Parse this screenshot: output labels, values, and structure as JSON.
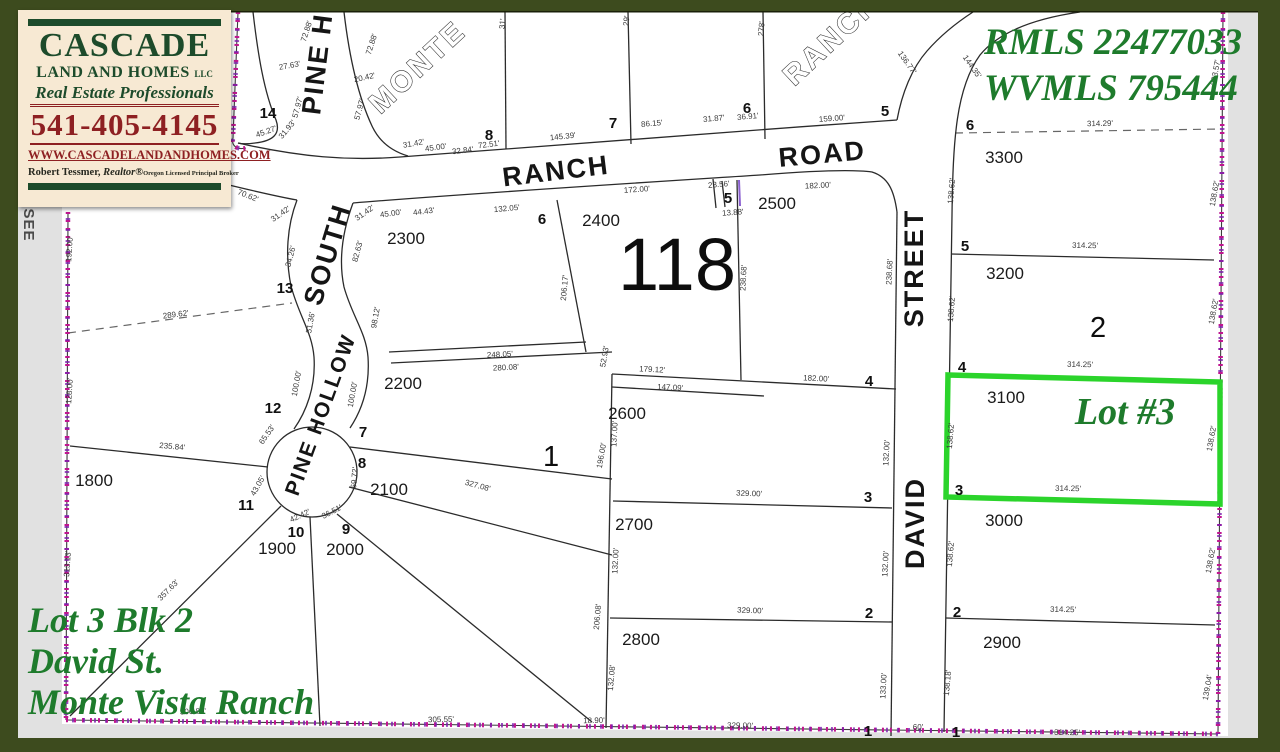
{
  "branding": {
    "company_line1": "CASCADE",
    "company_line2": "LAND AND HOMES",
    "company_suffix": "LLC",
    "tagline": "Real Estate Professionals",
    "phone": "541-405-4145",
    "website": "WWW.CASCADELANDANDHOMES.COM",
    "agent_name": "Robert Tessmer,",
    "agent_designation": "Realtor®",
    "agent_license": "Oregon Licensed Principal Broker"
  },
  "listing": {
    "mls_line1": "RMLS 22477033",
    "mls_line2": "WVMLS 795444",
    "highlight_label": "Lot #3",
    "caption_line1": "Lot 3 Blk 2",
    "caption_line2": "David St.",
    "caption_line3": "Monte Vista Ranch"
  },
  "colors": {
    "frame_green": "#3d4b1e",
    "page_gray": "#e1e1e1",
    "logo_cream": "#f7e9d3",
    "logo_green": "#1d4b2b",
    "logo_maroon": "#8e2022",
    "annotation_green": "#1e7b2c",
    "highlight_green": "#2bd42b",
    "boundary_magenta": "#c01590",
    "line_dark": "#2b2b2b"
  },
  "map": {
    "section_number": "118",
    "edge_note": "SEE",
    "labels": [
      {
        "t": "PINE HOLLOW",
        "x": 333,
        "y": 10,
        "r": -83,
        "c": "street"
      },
      {
        "t": "MONTE",
        "x": 424,
        "y": 74,
        "r": -43,
        "c": "outline"
      },
      {
        "t": "RANCH",
        "x": 838,
        "y": 46,
        "r": -43,
        "c": "outline"
      },
      {
        "t": "RANCH",
        "x": 557,
        "y": 180,
        "r": -7,
        "c": "street"
      },
      {
        "t": "ROAD",
        "x": 823,
        "y": 163,
        "r": -5,
        "c": "street"
      },
      {
        "t": "SOUTH",
        "x": 336,
        "y": 257,
        "r": -73,
        "c": "street"
      },
      {
        "t": "PINE HOLLOW",
        "x": 327,
        "y": 417,
        "r": -70,
        "c": "streetsm"
      },
      {
        "t": "DAVID",
        "x": 924,
        "y": 523,
        "r": -90,
        "c": "street"
      },
      {
        "t": "STREET",
        "x": 923,
        "y": 268,
        "r": -90,
        "c": "street"
      },
      {
        "t": "118",
        "x": 677,
        "y": 290,
        "c": "sec"
      },
      {
        "t": "1",
        "x": 551,
        "y": 466,
        "c": "blk"
      },
      {
        "t": "2",
        "x": 1098,
        "y": 337,
        "c": "blk"
      },
      {
        "t": "SEE",
        "x": 24,
        "y": 225,
        "r": 90,
        "c": "note"
      },
      {
        "t": "14",
        "x": 268,
        "y": 118,
        "c": "lot"
      },
      {
        "t": "8",
        "x": 489,
        "y": 140,
        "c": "lot"
      },
      {
        "t": "7",
        "x": 613,
        "y": 128,
        "c": "lot"
      },
      {
        "t": "6",
        "x": 747,
        "y": 113,
        "c": "lot"
      },
      {
        "t": "5",
        "x": 885,
        "y": 116,
        "c": "lot"
      },
      {
        "t": "6",
        "x": 542,
        "y": 224,
        "c": "lot"
      },
      {
        "t": "5",
        "x": 728,
        "y": 203,
        "c": "lot"
      },
      {
        "t": "13",
        "x": 285,
        "y": 293,
        "c": "lot"
      },
      {
        "t": "12",
        "x": 273,
        "y": 413,
        "c": "lot"
      },
      {
        "t": "11",
        "x": 246,
        "y": 510,
        "c": "lot"
      },
      {
        "t": "10",
        "x": 296,
        "y": 537,
        "c": "lot"
      },
      {
        "t": "9",
        "x": 346,
        "y": 534,
        "c": "lot"
      },
      {
        "t": "7",
        "x": 363,
        "y": 437,
        "c": "lot"
      },
      {
        "t": "8",
        "x": 362,
        "y": 468,
        "c": "lot"
      },
      {
        "t": "4",
        "x": 869,
        "y": 386,
        "c": "lot"
      },
      {
        "t": "3",
        "x": 868,
        "y": 502,
        "c": "lot"
      },
      {
        "t": "2",
        "x": 869,
        "y": 618,
        "c": "lot"
      },
      {
        "t": "1",
        "x": 868,
        "y": 736,
        "c": "lot"
      },
      {
        "t": "6",
        "x": 970,
        "y": 130,
        "c": "lot"
      },
      {
        "t": "5",
        "x": 965,
        "y": 251,
        "c": "lot"
      },
      {
        "t": "4",
        "x": 962,
        "y": 372,
        "c": "lot"
      },
      {
        "t": "3",
        "x": 959,
        "y": 495,
        "c": "lot"
      },
      {
        "t": "2",
        "x": 957,
        "y": 617,
        "c": "lot"
      },
      {
        "t": "1",
        "x": 956,
        "y": 737,
        "c": "lot"
      },
      {
        "t": "2300",
        "x": 406,
        "y": 244,
        "c": "parcel"
      },
      {
        "t": "2400",
        "x": 601,
        "y": 226,
        "c": "parcel"
      },
      {
        "t": "2500",
        "x": 777,
        "y": 209,
        "c": "parcel"
      },
      {
        "t": "2200",
        "x": 403,
        "y": 389,
        "c": "parcel"
      },
      {
        "t": "2600",
        "x": 627,
        "y": 419,
        "c": "parcel"
      },
      {
        "t": "2700",
        "x": 634,
        "y": 530,
        "c": "parcel"
      },
      {
        "t": "2800",
        "x": 641,
        "y": 645,
        "c": "parcel"
      },
      {
        "t": "2100",
        "x": 389,
        "y": 495,
        "c": "parcel"
      },
      {
        "t": "2000",
        "x": 345,
        "y": 555,
        "c": "parcel"
      },
      {
        "t": "1900",
        "x": 277,
        "y": 554,
        "c": "parcel"
      },
      {
        "t": "1800",
        "x": 94,
        "y": 486,
        "c": "parcel"
      },
      {
        "t": "3300",
        "x": 1004,
        "y": 163,
        "c": "parcel"
      },
      {
        "t": "3200",
        "x": 1005,
        "y": 279,
        "c": "parcel"
      },
      {
        "t": "3100",
        "x": 1006,
        "y": 403,
        "c": "parcel"
      },
      {
        "t": "3000",
        "x": 1004,
        "y": 526,
        "c": "parcel"
      },
      {
        "t": "2900",
        "x": 1002,
        "y": 648,
        "c": "parcel"
      },
      {
        "t": "72.88'",
        "x": 309,
        "y": 32,
        "r": -72
      },
      {
        "t": "72.88'",
        "x": 374,
        "y": 45,
        "r": -72
      },
      {
        "t": "27.63'",
        "x": 290,
        "y": 68,
        "r": -10
      },
      {
        "t": "20.42'",
        "x": 365,
        "y": 80,
        "r": -12
      },
      {
        "t": "57.97'",
        "x": 300,
        "y": 108,
        "r": -75
      },
      {
        "t": "57.97'",
        "x": 362,
        "y": 110,
        "r": -75
      },
      {
        "t": "45.27'",
        "x": 267,
        "y": 134,
        "r": -20
      },
      {
        "t": "31.93'",
        "x": 289,
        "y": 131,
        "r": -50
      },
      {
        "t": "31'",
        "x": 505,
        "y": 24,
        "r": -85
      },
      {
        "t": "29'",
        "x": 629,
        "y": 21,
        "r": -85
      },
      {
        "t": "278'",
        "x": 764,
        "y": 29,
        "r": -85
      },
      {
        "t": "31.42'",
        "x": 414,
        "y": 146,
        "r": -10
      },
      {
        "t": "45.00'",
        "x": 436,
        "y": 150,
        "r": -8
      },
      {
        "t": "32.84'",
        "x": 463,
        "y": 153,
        "r": -7
      },
      {
        "t": "72.51'",
        "x": 489,
        "y": 147,
        "r": -7
      },
      {
        "t": "145.39'",
        "x": 563,
        "y": 139,
        "r": -6
      },
      {
        "t": "86.15'",
        "x": 652,
        "y": 126,
        "r": -5
      },
      {
        "t": "31.87'",
        "x": 714,
        "y": 121,
        "r": -5
      },
      {
        "t": "36.91'",
        "x": 748,
        "y": 119,
        "r": -5
      },
      {
        "t": "159.00'",
        "x": 832,
        "y": 121,
        "r": -4
      },
      {
        "t": "136.77'",
        "x": 905,
        "y": 64,
        "r": 55
      },
      {
        "t": "144.35'",
        "x": 970,
        "y": 68,
        "r": 55
      },
      {
        "t": "70.62'",
        "x": 247,
        "y": 198,
        "r": 22
      },
      {
        "t": "31.42'",
        "x": 282,
        "y": 216,
        "r": -35
      },
      {
        "t": "31.42'",
        "x": 366,
        "y": 215,
        "r": -35
      },
      {
        "t": "45.00'",
        "x": 391,
        "y": 216,
        "r": -8
      },
      {
        "t": "44.43'",
        "x": 424,
        "y": 214,
        "r": -7
      },
      {
        "t": "132.05'",
        "x": 507,
        "y": 211,
        "r": -5
      },
      {
        "t": "172.00'",
        "x": 637,
        "y": 192,
        "r": -4
      },
      {
        "t": "23.56'",
        "x": 719,
        "y": 187,
        "r": -5
      },
      {
        "t": "13.88'",
        "x": 733,
        "y": 215,
        "r": -4
      },
      {
        "t": "182.00'",
        "x": 818,
        "y": 188,
        "r": -3
      },
      {
        "t": "34.26'",
        "x": 293,
        "y": 257,
        "r": -75
      },
      {
        "t": "82.63'",
        "x": 360,
        "y": 252,
        "r": -75
      },
      {
        "t": "51.36'",
        "x": 313,
        "y": 323,
        "r": -80
      },
      {
        "t": "98.12'",
        "x": 378,
        "y": 318,
        "r": -80
      },
      {
        "t": "100.00'",
        "x": 299,
        "y": 384,
        "r": -80
      },
      {
        "t": "100.00'",
        "x": 355,
        "y": 395,
        "r": -80
      },
      {
        "t": "192.00'",
        "x": 72,
        "y": 249,
        "r": -86
      },
      {
        "t": "128.00'",
        "x": 72,
        "y": 391,
        "r": -86
      },
      {
        "t": "313.13'",
        "x": 70,
        "y": 564,
        "r": -86
      },
      {
        "t": "289.62'",
        "x": 176,
        "y": 317,
        "r": -7
      },
      {
        "t": "235.84'",
        "x": 172,
        "y": 449,
        "r": 5
      },
      {
        "t": "65.53'",
        "x": 269,
        "y": 436,
        "r": -55
      },
      {
        "t": "43.05'",
        "x": 260,
        "y": 487,
        "r": -60
      },
      {
        "t": "42.42'",
        "x": 301,
        "y": 518,
        "r": -25
      },
      {
        "t": "36.51'",
        "x": 333,
        "y": 514,
        "r": -28
      },
      {
        "t": "69.72'",
        "x": 357,
        "y": 478,
        "r": -85
      },
      {
        "t": "357.63'",
        "x": 170,
        "y": 592,
        "r": -45
      },
      {
        "t": "327.08'",
        "x": 477,
        "y": 488,
        "r": 15
      },
      {
        "t": "248.05'",
        "x": 500,
        "y": 357,
        "r": -3
      },
      {
        "t": "280.08'",
        "x": 506,
        "y": 370,
        "r": -3
      },
      {
        "t": "206.17'",
        "x": 567,
        "y": 288,
        "r": -85
      },
      {
        "t": "52.93'",
        "x": 607,
        "y": 357,
        "r": -80
      },
      {
        "t": "238.68'",
        "x": 746,
        "y": 278,
        "r": -87
      },
      {
        "t": "238.68'",
        "x": 892,
        "y": 272,
        "r": -87
      },
      {
        "t": "179.12'",
        "x": 652,
        "y": 372,
        "r": 3
      },
      {
        "t": "147.09'",
        "x": 670,
        "y": 390,
        "r": 3
      },
      {
        "t": "182.00'",
        "x": 816,
        "y": 381,
        "r": 3
      },
      {
        "t": "137.00'",
        "x": 617,
        "y": 434,
        "r": -87
      },
      {
        "t": "196.00'",
        "x": 604,
        "y": 456,
        "r": -80
      },
      {
        "t": "132.00'",
        "x": 889,
        "y": 453,
        "r": -87
      },
      {
        "t": "329.00'",
        "x": 749,
        "y": 496,
        "r": 2
      },
      {
        "t": "132.00'",
        "x": 618,
        "y": 561,
        "r": -87
      },
      {
        "t": "132.00'",
        "x": 888,
        "y": 564,
        "r": -87
      },
      {
        "t": "206.08'",
        "x": 600,
        "y": 617,
        "r": -85
      },
      {
        "t": "329.00'",
        "x": 750,
        "y": 613,
        "r": 2
      },
      {
        "t": "132.08'",
        "x": 614,
        "y": 678,
        "r": -85
      },
      {
        "t": "133.00'",
        "x": 886,
        "y": 686,
        "r": -87
      },
      {
        "t": "138.18'",
        "x": 950,
        "y": 683,
        "r": -85
      },
      {
        "t": "60'",
        "x": 918,
        "y": 730,
        "r": 0
      },
      {
        "t": "306.80'",
        "x": 193,
        "y": 714,
        "r": -2
      },
      {
        "t": "305.55'",
        "x": 441,
        "y": 722,
        "r": -1
      },
      {
        "t": "18.90'",
        "x": 594,
        "y": 723,
        "r": -1
      },
      {
        "t": "329.00'",
        "x": 740,
        "y": 728,
        "r": 1
      },
      {
        "t": "314.25'",
        "x": 1067,
        "y": 735,
        "r": 1
      },
      {
        "t": "314.29'",
        "x": 1100,
        "y": 126,
        "r": -1
      },
      {
        "t": "314.25'",
        "x": 1085,
        "y": 248,
        "r": 1
      },
      {
        "t": "314.25'",
        "x": 1080,
        "y": 367,
        "r": 1
      },
      {
        "t": "314.25'",
        "x": 1068,
        "y": 491,
        "r": 1
      },
      {
        "t": "314.25'",
        "x": 1063,
        "y": 612,
        "r": 1
      },
      {
        "t": "138.62'",
        "x": 954,
        "y": 191,
        "r": -85
      },
      {
        "t": "138.62'",
        "x": 954,
        "y": 309,
        "r": -85
      },
      {
        "t": "138.62'",
        "x": 953,
        "y": 436,
        "r": -85
      },
      {
        "t": "138.62'",
        "x": 953,
        "y": 554,
        "r": -85
      },
      {
        "t": "203.57'",
        "x": 1218,
        "y": 73,
        "r": -80
      },
      {
        "t": "138.62'",
        "x": 1217,
        "y": 194,
        "r": -80
      },
      {
        "t": "138.62'",
        "x": 1216,
        "y": 312,
        "r": -80
      },
      {
        "t": "138.62'",
        "x": 1214,
        "y": 439,
        "r": -80
      },
      {
        "t": "138.62'",
        "x": 1213,
        "y": 561,
        "r": -80
      },
      {
        "t": "139.04'",
        "x": 1210,
        "y": 688,
        "r": -80
      }
    ]
  }
}
